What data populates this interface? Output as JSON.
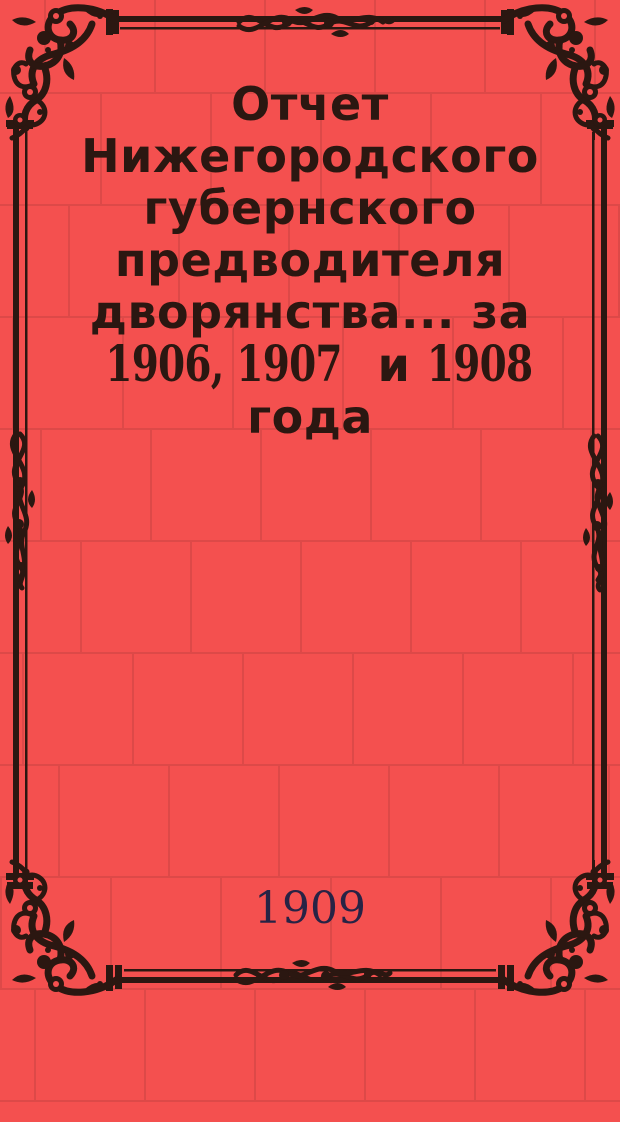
{
  "colors": {
    "background": "#f4504f",
    "mortar": "#dd4948",
    "ink": "#2b1711",
    "year_ink": "#272345"
  },
  "cover": {
    "title_lines": [
      "Отчет",
      "Нижегородского",
      "губернского",
      "предводителя",
      "дворянства... за",
      "года"
    ],
    "years_line": {
      "group1": "1906, 1907",
      "conjunction": "и",
      "group2": "1908"
    },
    "publication_year": "1909"
  }
}
